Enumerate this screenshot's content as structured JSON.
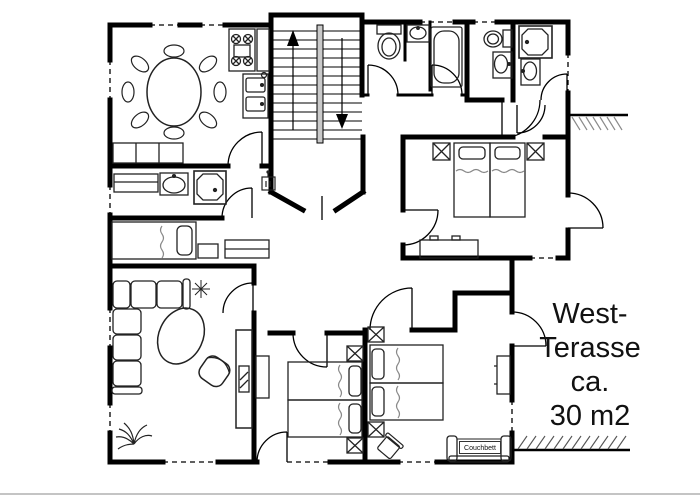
{
  "plan": {
    "terrace_label": [
      "West-",
      "Terasse",
      "ca.",
      "30 m2"
    ],
    "couch_label": "Couchbett",
    "colors": {
      "walls": "#000000",
      "furniture_line": "#222222",
      "soft_line": "#888888",
      "stair_core_fill": "#c9c9c9",
      "hatch_top": "#8a8a8a",
      "hatch_bottom": "#555555",
      "page_rule": "#b0b0b0",
      "background": "#ffffff"
    },
    "icons": {
      "stairs-up-arrow": "solid triangle up with stem",
      "stairs-down-arrow": "solid triangle down with stem",
      "dining-table-icon": "oval table with 8 chair ellipses",
      "stove-icon": "square with 4 crossed burner circles",
      "kitchen-sink-icon": "counter with two basins",
      "sideboard-icon": "3-cell rectangle",
      "washbasin-icon": "oval basin in rectangle",
      "shower-icon": "octagon in square",
      "toilet-icon": "bowl ellipse with tank",
      "bathtub-icon": "rounded tub in rectangle",
      "bed-icon": "mattress with pillow and wavy blanket line",
      "nightstand-icon": "square with X",
      "dresser-icon": "rectangle with two handles",
      "sofa-icon": "L-shaped cushion group",
      "coffee-table-icon": "tilted oval",
      "armchair-icon": "rounded rotated seat",
      "plant-icon": "star burst",
      "palm-plant-icon": "radiating fronds",
      "couch-bed-icon": "couch with armrests and label",
      "wall-switch-icon": "small box with two ticks",
      "door-swing": "quarter-circle arc with leaf",
      "window-marker": "dashed wall gap",
      "terrace-hatch": "diagonal ground strokes"
    }
  }
}
